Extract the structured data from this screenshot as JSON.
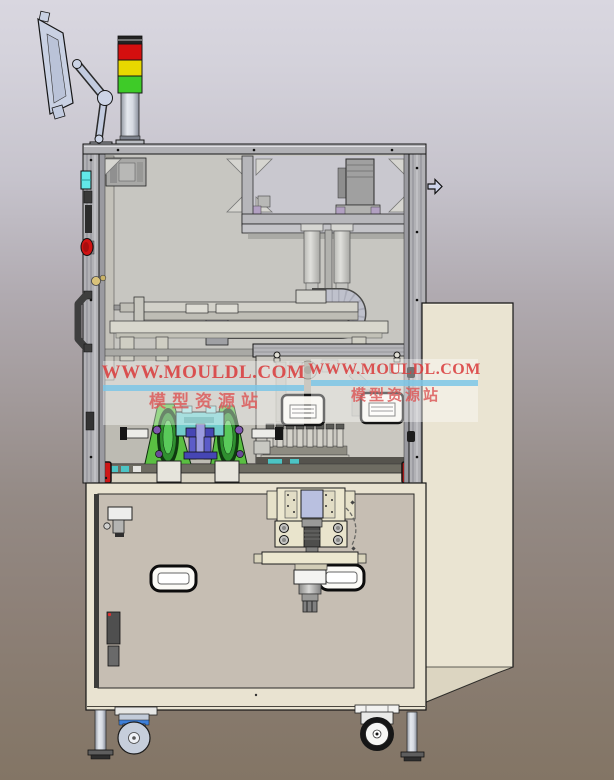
{
  "watermark": {
    "site_url": "WWW.MOULDL.COM",
    "site_name": "模型资源站"
  },
  "colors": {
    "background_top": "#d9d7e0",
    "background_bottom": "#837565",
    "tower_red": "#d40f0f",
    "tower_yellow": "#e8d800",
    "tower_green": "#3ecb28",
    "frame_aluminum": "#b1b1b5",
    "enclosure_interior": "#c7c6c1",
    "cabinet_cream": "#e9e3d1",
    "cabinet_panel": "#c6beb3",
    "corner_bracket_red": "#cf1616",
    "mechanism_green": "#5abf42",
    "mechanism_teal": "#72cccb",
    "mechanism_blue": "#4646b4",
    "watermark_url_red": "#da3e3e",
    "watermark_underline_blue": "#7dc6e6",
    "watermark_name_pink": "#dc5a5a"
  }
}
